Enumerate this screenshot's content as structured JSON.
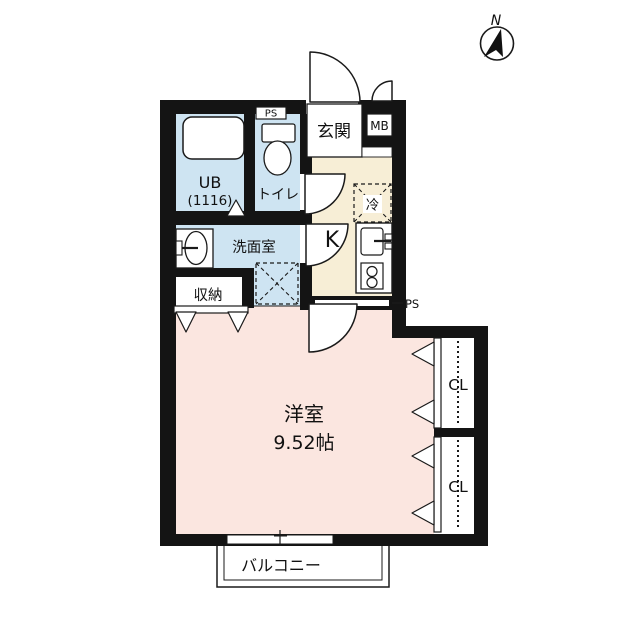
{
  "compass": {
    "north_label": "N"
  },
  "labels": {
    "entrance": "玄関",
    "meter_box": "MB",
    "pipe_space_toilet": "PS",
    "pipe_space_kitchen": "PS",
    "unit_bath_line1": "UB",
    "unit_bath_line2": "(1116)",
    "toilet": "トイレ",
    "washroom": "洗面室",
    "storage": "収納",
    "kitchen": "K",
    "refrigerator": "冷",
    "western_room_name": "洋室",
    "western_room_size": "9.52帖",
    "closet_upper": "CL",
    "closet_lower": "CL",
    "balcony": "バルコニー"
  },
  "colors": {
    "wet_area": "#CEE4F2",
    "hall_kitchen": "#F7EED6",
    "main_room": "#FBE6E0",
    "wall": "#141414"
  }
}
